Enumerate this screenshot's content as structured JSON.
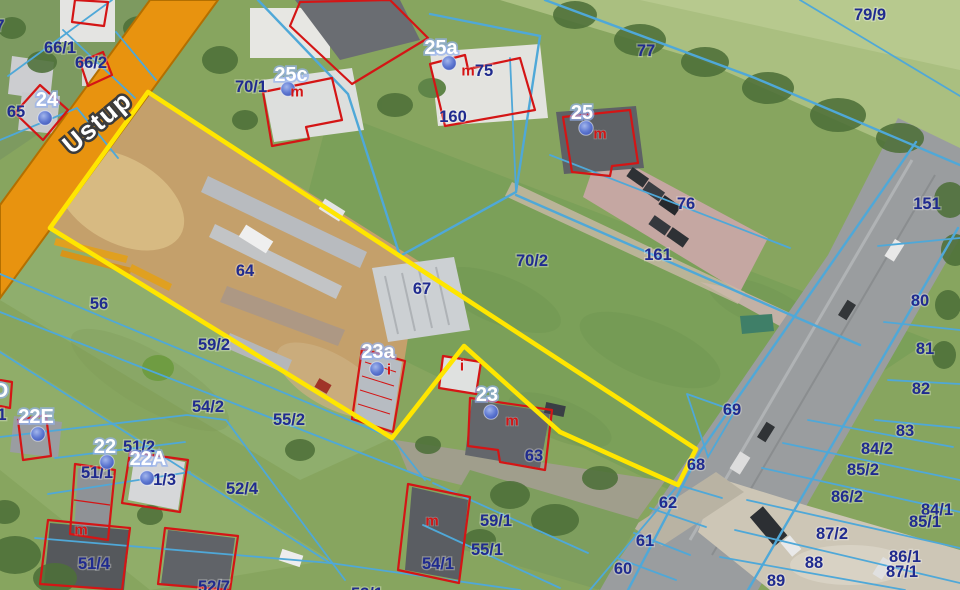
{
  "map": {
    "road_name": "Ustup",
    "colors": {
      "highlight": "#ffe600",
      "parcel_line": "#4fa8d8",
      "parcel_label": "#202b8f",
      "address_label": "#ffffff",
      "building_outline": "#d41515",
      "building_mark": "#d41515",
      "road_fill": "#e8930f",
      "address_dot": "#5572cf"
    },
    "parcel_labels": [
      {
        "t": "7",
        "x": 0,
        "y": 26
      },
      {
        "t": "66/1",
        "x": 60,
        "y": 48
      },
      {
        "t": "66/2",
        "x": 91,
        "y": 63
      },
      {
        "t": "65",
        "x": 16,
        "y": 112
      },
      {
        "t": "70/1",
        "x": 251,
        "y": 87
      },
      {
        "t": "75",
        "x": 484,
        "y": 71
      },
      {
        "t": "160",
        "x": 453,
        "y": 117
      },
      {
        "t": "77",
        "x": 646,
        "y": 51
      },
      {
        "t": "79/9",
        "x": 870,
        "y": 15
      },
      {
        "t": "76",
        "x": 686,
        "y": 204
      },
      {
        "t": "151",
        "x": 927,
        "y": 204
      },
      {
        "t": "161",
        "x": 658,
        "y": 255
      },
      {
        "t": "70/2",
        "x": 532,
        "y": 261
      },
      {
        "t": "64",
        "x": 245,
        "y": 271
      },
      {
        "t": "67",
        "x": 422,
        "y": 289
      },
      {
        "t": "56",
        "x": 99,
        "y": 304
      },
      {
        "t": "59/2",
        "x": 214,
        "y": 345
      },
      {
        "t": "63",
        "x": 534,
        "y": 456
      },
      {
        "t": "69",
        "x": 732,
        "y": 410
      },
      {
        "t": "68",
        "x": 696,
        "y": 465
      },
      {
        "t": "62",
        "x": 668,
        "y": 503
      },
      {
        "t": "61",
        "x": 645,
        "y": 541
      },
      {
        "t": "60",
        "x": 623,
        "y": 569
      },
      {
        "t": "80",
        "x": 920,
        "y": 301
      },
      {
        "t": "81",
        "x": 925,
        "y": 349
      },
      {
        "t": "82",
        "x": 921,
        "y": 389
      },
      {
        "t": "83",
        "x": 905,
        "y": 431
      },
      {
        "t": "84/2",
        "x": 877,
        "y": 449
      },
      {
        "t": "85/2",
        "x": 863,
        "y": 470
      },
      {
        "t": "86/2",
        "x": 847,
        "y": 497
      },
      {
        "t": "84/1",
        "x": 937,
        "y": 510
      },
      {
        "t": "85/1",
        "x": 925,
        "y": 522
      },
      {
        "t": "87/2",
        "x": 832,
        "y": 534
      },
      {
        "t": "86/1",
        "x": 905,
        "y": 557
      },
      {
        "t": "87/1",
        "x": 902,
        "y": 572
      },
      {
        "t": "88",
        "x": 814,
        "y": 563
      },
      {
        "t": "89",
        "x": 776,
        "y": 581
      },
      {
        "t": "54/2",
        "x": 208,
        "y": 407
      },
      {
        "t": "55/2",
        "x": 289,
        "y": 420
      },
      {
        "t": "51/2",
        "x": 139,
        "y": 447
      },
      {
        "t": "51/1",
        "x": 97,
        "y": 473
      },
      {
        "t": "51/3",
        "x": 160,
        "y": 480
      },
      {
        "t": "52/4",
        "x": 242,
        "y": 489
      },
      {
        "t": "51/4",
        "x": 94,
        "y": 564
      },
      {
        "t": "52/7",
        "x": 214,
        "y": 587
      },
      {
        "t": "53/1",
        "x": 367,
        "y": 594
      },
      {
        "t": "59/1",
        "x": 496,
        "y": 521
      },
      {
        "t": "55/1",
        "x": 487,
        "y": 550
      },
      {
        "t": "54/1",
        "x": 438,
        "y": 564
      },
      {
        "t": "1",
        "x": 2,
        "y": 415
      }
    ],
    "address_points": [
      {
        "t": "24",
        "x": 47,
        "y": 100,
        "dx": 45,
        "dy": 118
      },
      {
        "t": "25c",
        "x": 291,
        "y": 75,
        "dx": 288,
        "dy": 89
      },
      {
        "t": "25a",
        "x": 441,
        "y": 48,
        "dx": 449,
        "dy": 63
      },
      {
        "t": "25",
        "x": 582,
        "y": 113,
        "dx": 586,
        "dy": 128
      },
      {
        "t": "23a",
        "x": 378,
        "y": 352,
        "dx": 377,
        "dy": 369
      },
      {
        "t": "23",
        "x": 487,
        "y": 395,
        "dx": 491,
        "dy": 412
      },
      {
        "t": "22E",
        "x": 36,
        "y": 417,
        "dx": 38,
        "dy": 434
      },
      {
        "t": "22",
        "x": 105,
        "y": 447,
        "dx": 107,
        "dy": 462
      },
      {
        "t": "22A",
        "x": 148,
        "y": 459,
        "dx": 147,
        "dy": 478
      },
      {
        "t": "D",
        "x": 1,
        "y": 391
      }
    ],
    "building_marks": [
      {
        "t": "m",
        "x": 297,
        "y": 92
      },
      {
        "t": "m",
        "x": 468,
        "y": 71
      },
      {
        "t": "m",
        "x": 600,
        "y": 134
      },
      {
        "t": "m",
        "x": 512,
        "y": 421
      },
      {
        "t": "m",
        "x": 432,
        "y": 521
      },
      {
        "t": "m",
        "x": 81,
        "y": 530
      },
      {
        "t": "i",
        "x": 389,
        "y": 370
      },
      {
        "t": "i",
        "x": 462,
        "y": 366
      }
    ]
  }
}
